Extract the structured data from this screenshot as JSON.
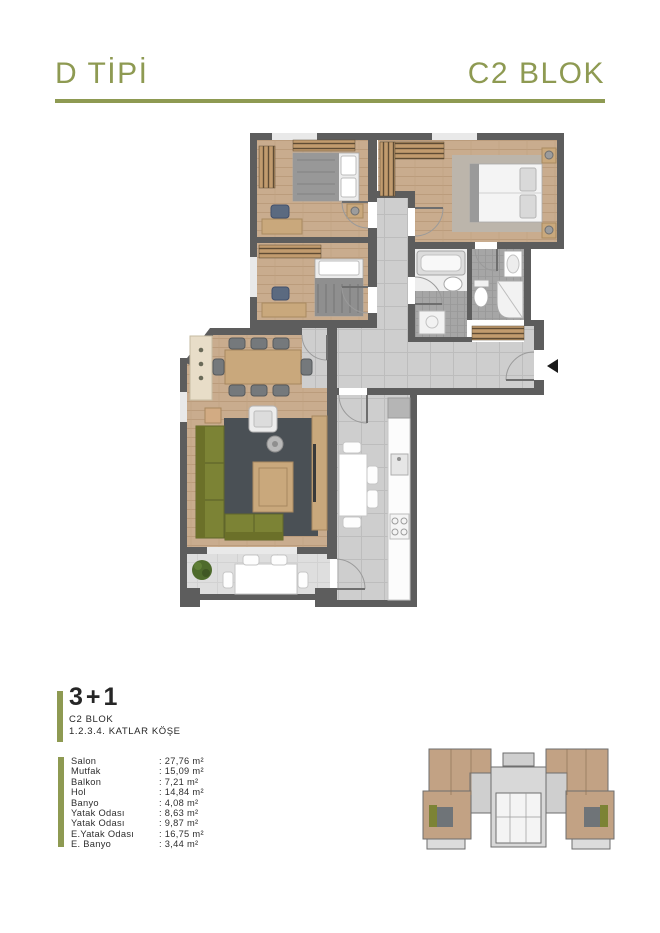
{
  "header": {
    "type_label": "D TİPİ",
    "block_label": "C2 BLOK",
    "accent_color": "#8e9a52"
  },
  "unit": {
    "rooms_label": "3+1",
    "block": "C2 BLOK",
    "floors": "1.2.3.4. KATLAR KÖŞE"
  },
  "areas": {
    "rows": [
      {
        "label": "Salon",
        "value": ": 27,76 m²"
      },
      {
        "label": "Mutfak",
        "value": ": 15,09 m²"
      },
      {
        "label": "Balkon",
        "value": ": 7,21 m²"
      },
      {
        "label": "Hol",
        "value": ": 14,84 m²"
      },
      {
        "label": "Banyo",
        "value": ": 4,08 m²"
      },
      {
        "label": "Yatak Odası",
        "value": ": 8,63 m²"
      },
      {
        "label": "Yatak Odası",
        "value": ": 9,87 m²"
      },
      {
        "label": "E.Yatak Odası",
        "value": ": 16,75 m²"
      },
      {
        "label": "E. Banyo",
        "value": ": 3,44 m²"
      }
    ]
  },
  "floor_plan": {
    "colors": {
      "wall": "#5d5d5d",
      "wood_floor": "#c9ac8e",
      "tile_floor": "#cecece",
      "balcony_floor": "#dedede",
      "rug": "#4a5055",
      "sofa_olive": "#7c8335",
      "bath_mosaic": "#a6a6a6"
    }
  }
}
